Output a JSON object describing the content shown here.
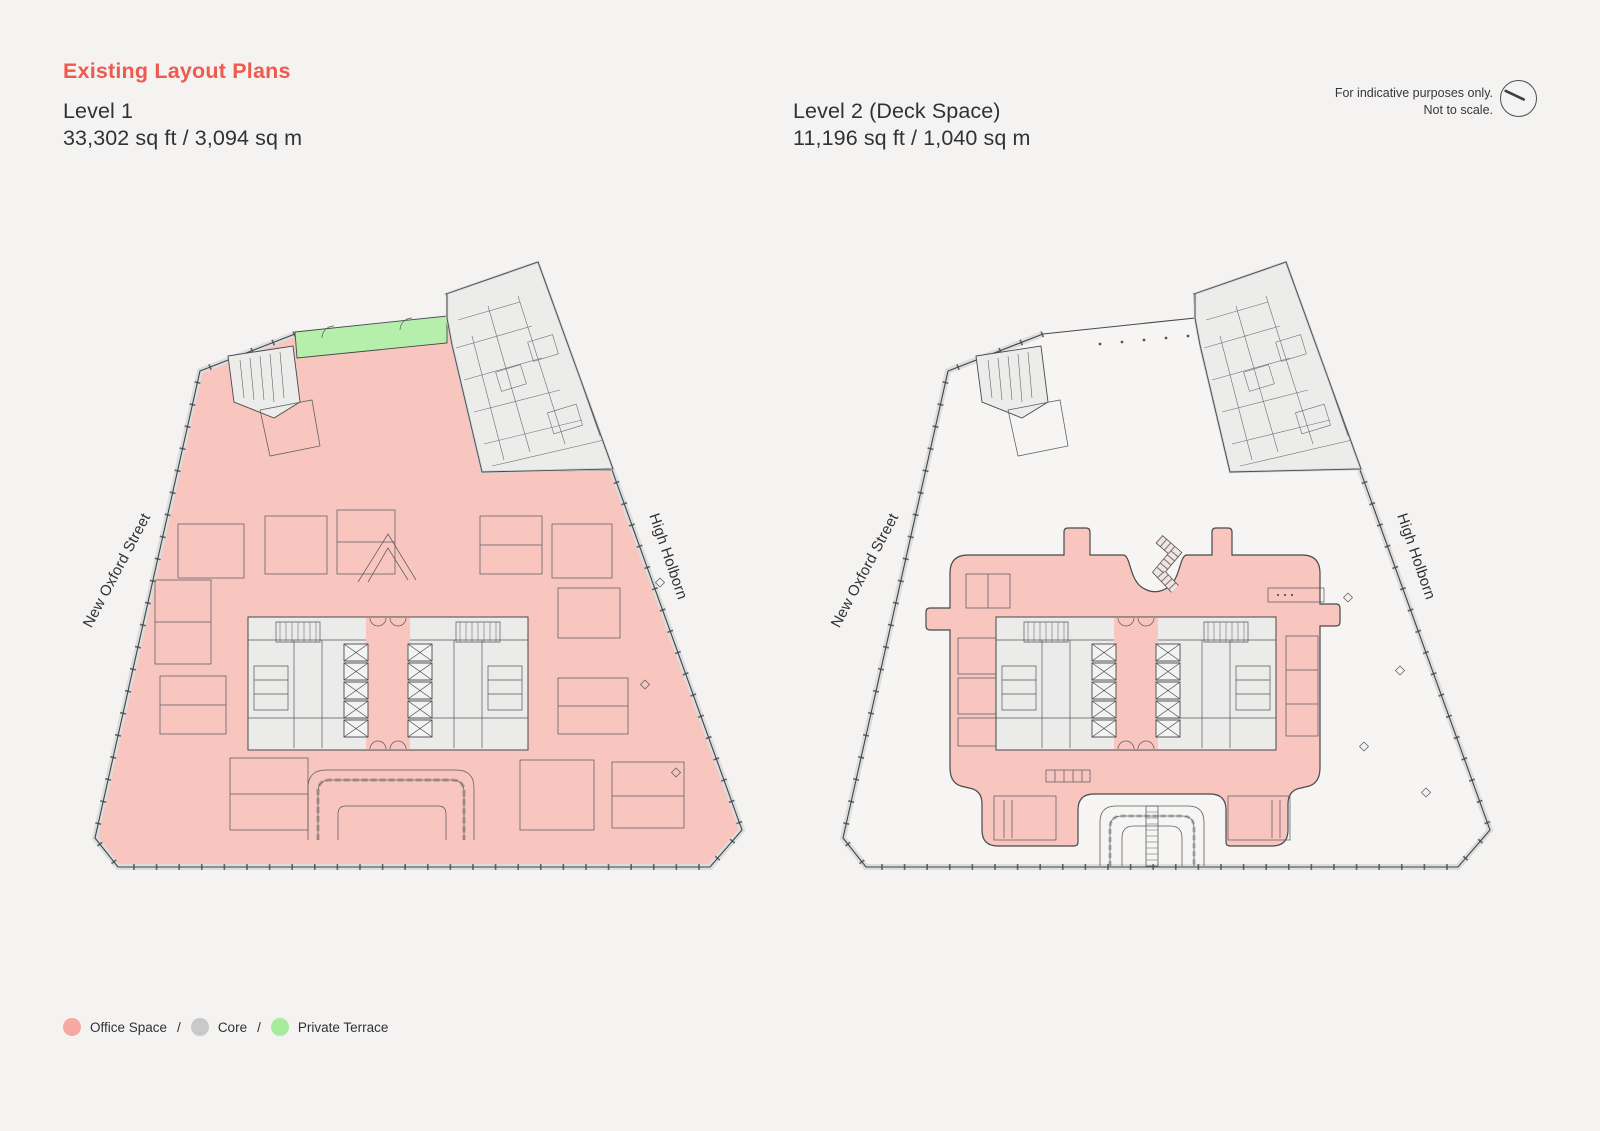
{
  "page": {
    "title": "Existing Layout Plans",
    "background": "#f4f3f1",
    "accent": "#f0594e"
  },
  "disclaimer": {
    "line1": "For indicative purposes only.",
    "line2": "Not to scale.",
    "icon": "compass-icon"
  },
  "plans": {
    "level1": {
      "name": "Level 1",
      "area": "33,302 sq ft / 3,094 sq m",
      "street_left": "New Oxford Street",
      "street_right": "High Holborn"
    },
    "level2": {
      "name": "Level 2 (Deck Space)",
      "area": "11,196 sq ft / 1,040 sq m",
      "street_left": "New Oxford Street",
      "street_right": "High Holborn"
    }
  },
  "legend": {
    "separator": "/",
    "items": [
      {
        "label": "Office Space",
        "color": "#f5a9a2"
      },
      {
        "label": "Core",
        "color": "#c9c9c9"
      },
      {
        "label": "Private Terrace",
        "color": "#a5ec9d"
      }
    ]
  },
  "colors": {
    "office_fill": "#f9c5bf",
    "core_fill": "#ebebe9",
    "terrace_fill": "#b6eeab",
    "outline": "#46494d"
  }
}
